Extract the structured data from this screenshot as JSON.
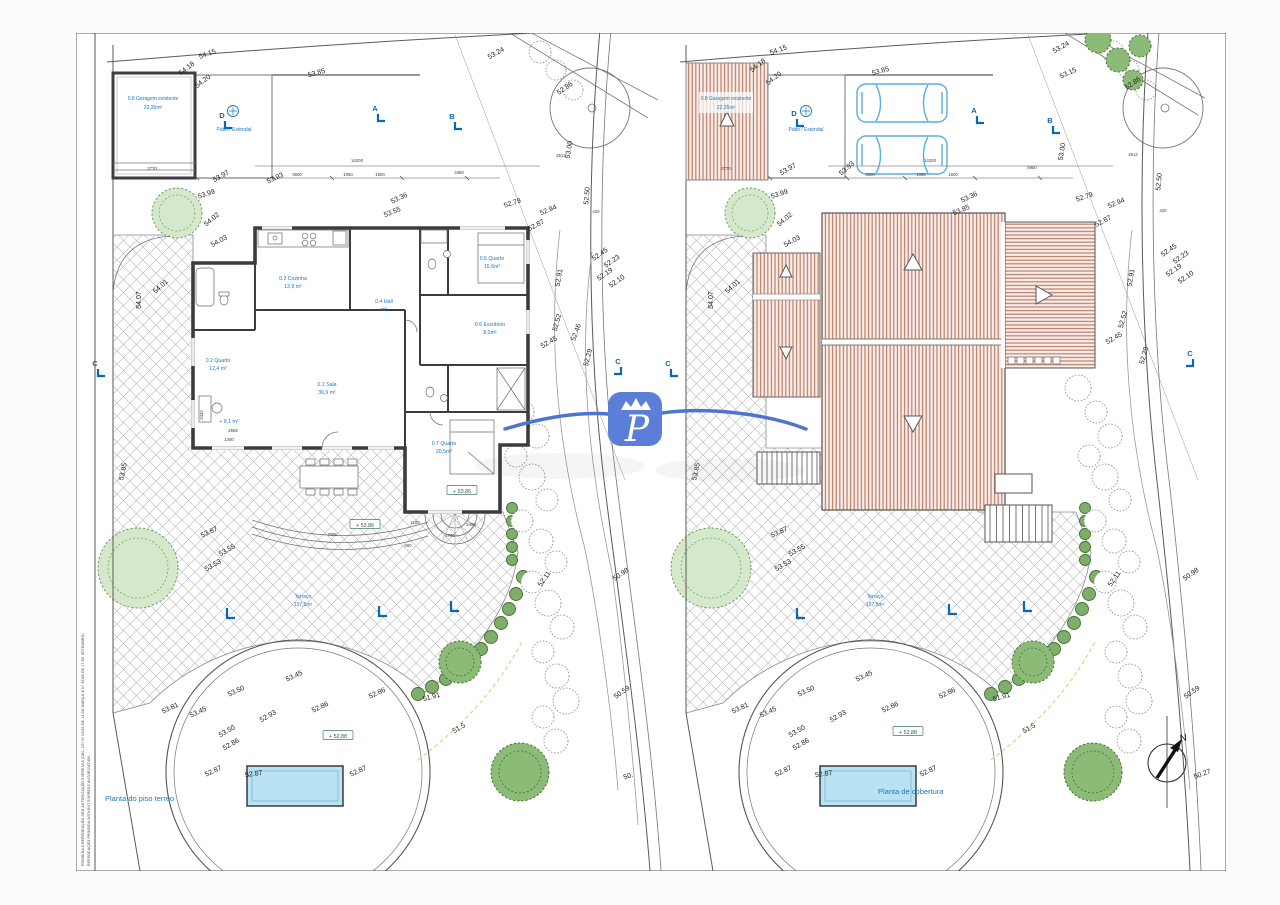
{
  "colors": {
    "blue_label": "#1878be",
    "marker_blue": "#0c67b0",
    "roof_stripe": "#c28472",
    "pool_fill": "#b9e2f2",
    "logo_blue": "#5b7ed8",
    "swoosh_blue": "#4f74d0"
  },
  "watermark": {
    "logo_letter": "P"
  },
  "copyright": {
    "line1": "PROIBIDA A REPRODUÇÃO SEM AUTORIZAÇÃO EXPRESSA (DEC. LEI Nº 63/85 DE 14 DE MARÇO E Nº 45/85 DE 17 DE SETEMBRO)",
    "line2": "REPRODUÇÃO PROIBIDA WITHOUT EXPRESS AUTORIZATION"
  },
  "left_plan": {
    "title": "Planta do piso terreo",
    "markers": [
      {
        "t": "D",
        "x": 222,
        "y": 118
      },
      {
        "t": "A",
        "x": 375,
        "y": 111
      },
      {
        "t": "B",
        "x": 452,
        "y": 119
      },
      {
        "t": "C",
        "x": 95,
        "y": 366
      },
      {
        "t": "C",
        "x": 618,
        "y": 364,
        "m": -1
      }
    ],
    "boxes": [
      {
        "t": "+ 53.86",
        "x": 365,
        "y": 526
      },
      {
        "t": "+ 53.86",
        "x": 462,
        "y": 492
      },
      {
        "t": "+ 52.88",
        "x": 338,
        "y": 737
      }
    ],
    "texts": [
      {
        "t": "0.8 Garagem existente",
        "x": 153,
        "y": 100,
        "c": "b6"
      },
      {
        "t": "22,26m²",
        "x": 153,
        "y": 109,
        "c": "b6"
      },
      {
        "t": "Pátio / Estendal",
        "x": 234,
        "y": 131,
        "c": "b6"
      },
      {
        "t": "0.1 Sala",
        "x": 327,
        "y": 386,
        "c": "r"
      },
      {
        "t": "36,9 m²",
        "x": 327,
        "y": 394,
        "c": "r"
      },
      {
        "t": "0.2 Quarto",
        "x": 218,
        "y": 362,
        "c": "r"
      },
      {
        "t": "12,4 m²",
        "x": 218,
        "y": 370,
        "c": "r"
      },
      {
        "t": "0.3 Cozinha",
        "x": 293,
        "y": 280,
        "c": "r"
      },
      {
        "t": "12,9 m²",
        "x": 293,
        "y": 288,
        "c": "r"
      },
      {
        "t": "0.4 Hall",
        "x": 384,
        "y": 303,
        "c": "r"
      },
      {
        "t": "m²",
        "x": 384,
        "y": 311,
        "c": "r"
      },
      {
        "t": "0.5 Quarto",
        "x": 492,
        "y": 260,
        "c": "r"
      },
      {
        "t": "15,6m²",
        "x": 492,
        "y": 268,
        "c": "r"
      },
      {
        "t": "0.6 Escritório",
        "x": 490,
        "y": 326,
        "c": "r"
      },
      {
        "t": "8,0m²",
        "x": 490,
        "y": 334,
        "c": "r"
      },
      {
        "t": "0.7 Quarto",
        "x": 444,
        "y": 445,
        "c": "r"
      },
      {
        "t": "20,5m²",
        "x": 444,
        "y": 453,
        "c": "r"
      },
      {
        "t": "+ 8,1 m²",
        "x": 229,
        "y": 423,
        "c": "r"
      },
      {
        "t": "Terraço",
        "x": 303,
        "y": 598,
        "c": "b6"
      },
      {
        "t": "137,5m²",
        "x": 303,
        "y": 606,
        "c": "b6"
      },
      {
        "t": "54.15",
        "x": 208,
        "y": 56,
        "r": -20,
        "c": "e"
      },
      {
        "t": "54.18",
        "x": 188,
        "y": 70,
        "r": -38,
        "c": "e"
      },
      {
        "t": "54.20",
        "x": 204,
        "y": 83,
        "r": -38,
        "c": "e"
      },
      {
        "t": "53.85",
        "x": 317,
        "y": 75,
        "r": -15,
        "c": "e"
      },
      {
        "t": "53.24",
        "x": 497,
        "y": 55,
        "r": -30,
        "c": "e"
      },
      {
        "t": "52.86",
        "x": 566,
        "y": 90,
        "r": -35,
        "c": "e"
      },
      {
        "t": "53.97",
        "x": 222,
        "y": 178,
        "r": -30,
        "c": "e"
      },
      {
        "t": "53.93",
        "x": 276,
        "y": 180,
        "r": -25,
        "c": "e"
      },
      {
        "t": "53.99",
        "x": 207,
        "y": 196,
        "r": -18,
        "c": "e"
      },
      {
        "t": "54.02",
        "x": 213,
        "y": 221,
        "r": -40,
        "c": "e"
      },
      {
        "t": "54.03",
        "x": 220,
        "y": 243,
        "r": -28,
        "c": "e"
      },
      {
        "t": "54.01",
        "x": 162,
        "y": 288,
        "r": -42,
        "c": "e"
      },
      {
        "t": "54.07",
        "x": 141,
        "y": 300,
        "r": -90,
        "c": "e"
      },
      {
        "t": "53.85",
        "x": 125,
        "y": 472,
        "r": -78,
        "c": "e"
      },
      {
        "t": "53.36",
        "x": 400,
        "y": 200,
        "r": -25,
        "c": "e"
      },
      {
        "t": "53.55",
        "x": 393,
        "y": 214,
        "r": -22,
        "c": "e"
      },
      {
        "t": "53.00",
        "x": 571,
        "y": 150,
        "r": -80,
        "c": "e"
      },
      {
        "t": "52.50",
        "x": 589,
        "y": 196,
        "r": -85,
        "c": "e"
      },
      {
        "t": "52.79",
        "x": 513,
        "y": 205,
        "r": -18,
        "c": "e"
      },
      {
        "t": "52.94",
        "x": 549,
        "y": 212,
        "r": -22,
        "c": "e"
      },
      {
        "t": "52.87",
        "x": 537,
        "y": 227,
        "r": -28,
        "c": "e"
      },
      {
        "t": "52.45",
        "x": 601,
        "y": 256,
        "r": -35,
        "c": "e"
      },
      {
        "t": "52.23",
        "x": 613,
        "y": 263,
        "r": -35,
        "c": "e"
      },
      {
        "t": "52.19",
        "x": 606,
        "y": 276,
        "r": -35,
        "c": "e"
      },
      {
        "t": "52.10",
        "x": 618,
        "y": 283,
        "r": -35,
        "c": "e"
      },
      {
        "t": "52.91",
        "x": 561,
        "y": 278,
        "r": -80,
        "c": "e"
      },
      {
        "t": "52.52",
        "x": 559,
        "y": 323,
        "r": -75,
        "c": "e"
      },
      {
        "t": "52.46",
        "x": 578,
        "y": 333,
        "r": -70,
        "c": "e"
      },
      {
        "t": "52.45",
        "x": 550,
        "y": 344,
        "r": -30,
        "c": "e"
      },
      {
        "t": "52.29",
        "x": 590,
        "y": 358,
        "r": -75,
        "c": "e"
      },
      {
        "t": "53.87",
        "x": 210,
        "y": 534,
        "r": -25,
        "c": "e"
      },
      {
        "t": "53.55",
        "x": 228,
        "y": 552,
        "r": -30,
        "c": "e"
      },
      {
        "t": "53.53",
        "x": 214,
        "y": 567,
        "r": -30,
        "c": "e"
      },
      {
        "t": "52.11",
        "x": 546,
        "y": 580,
        "r": -55,
        "c": "e"
      },
      {
        "t": "50.98",
        "x": 622,
        "y": 576,
        "r": -35,
        "c": "e"
      },
      {
        "t": "53.45",
        "x": 295,
        "y": 678,
        "r": -25,
        "c": "e"
      },
      {
        "t": "53.50",
        "x": 237,
        "y": 693,
        "r": -25,
        "c": "e"
      },
      {
        "t": "53.81",
        "x": 171,
        "y": 710,
        "r": -25,
        "c": "e"
      },
      {
        "t": "53.45",
        "x": 199,
        "y": 714,
        "r": -25,
        "c": "e"
      },
      {
        "t": "53.50",
        "x": 228,
        "y": 733,
        "r": -30,
        "c": "e"
      },
      {
        "t": "52.86",
        "x": 232,
        "y": 746,
        "r": -30,
        "c": "e"
      },
      {
        "t": "52.93",
        "x": 269,
        "y": 718,
        "r": -30,
        "c": "e"
      },
      {
        "t": "52.86",
        "x": 321,
        "y": 709,
        "r": -25,
        "c": "e"
      },
      {
        "t": "52.86",
        "x": 378,
        "y": 695,
        "r": -25,
        "c": "e"
      },
      {
        "t": "51.91",
        "x": 432,
        "y": 699,
        "r": -15,
        "c": "e"
      },
      {
        "t": "51.5",
        "x": 460,
        "y": 730,
        "r": -30,
        "c": "e"
      },
      {
        "t": "50.59",
        "x": 623,
        "y": 694,
        "r": -35,
        "c": "e"
      },
      {
        "t": "52.87",
        "x": 214,
        "y": 773,
        "r": -25,
        "c": "e"
      },
      {
        "t": "52.87",
        "x": 254,
        "y": 776,
        "r": -8,
        "c": "e"
      },
      {
        "t": "52.87",
        "x": 359,
        "y": 773,
        "r": -25,
        "c": "e"
      },
      {
        "t": "50.",
        "x": 629,
        "y": 778,
        "r": -20,
        "c": "e"
      },
      {
        "t": "14200",
        "x": 357,
        "y": 162,
        "c": "d"
      },
      {
        "t": "3600",
        "x": 297,
        "y": 176,
        "c": "d"
      },
      {
        "t": "1050",
        "x": 348,
        "y": 176,
        "c": "d"
      },
      {
        "t": "1500",
        "x": 380,
        "y": 176,
        "c": "d"
      },
      {
        "t": "3450",
        "x": 459,
        "y": 174,
        "c": "d"
      },
      {
        "t": "2612",
        "x": 561,
        "y": 157,
        "c": "d"
      },
      {
        "t": "420",
        "x": 596,
        "y": 213,
        "c": "d"
      },
      {
        "t": "2770",
        "x": 152,
        "y": 170,
        "c": "d"
      },
      {
        "t": "7005",
        "x": 332,
        "y": 536,
        "c": "d"
      },
      {
        "t": "1100",
        "x": 415,
        "y": 524,
        "c": "d"
      },
      {
        "t": "2400",
        "x": 471,
        "y": 526,
        "c": "d"
      },
      {
        "t": "4700",
        "x": 450,
        "y": 537,
        "c": "d"
      },
      {
        "t": "400",
        "x": 408,
        "y": 547,
        "c": "d"
      },
      {
        "t": "2659",
        "x": 233,
        "y": 432,
        "c": "d"
      },
      {
        "t": "1400",
        "x": 229,
        "y": 441,
        "c": "d"
      },
      {
        "t": "2432",
        "x": 203,
        "y": 415,
        "r": -90,
        "c": "d"
      }
    ]
  },
  "right_plan": {
    "title": "Planta de cobertura",
    "markers": [
      {
        "t": "D",
        "x": 794,
        "y": 116
      },
      {
        "t": "A",
        "x": 974,
        "y": 113
      },
      {
        "t": "B",
        "x": 1050,
        "y": 123
      },
      {
        "t": "C",
        "x": 668,
        "y": 366
      },
      {
        "t": "C",
        "x": 1190,
        "y": 356,
        "m": -1
      }
    ],
    "boxes": [
      {
        "t": "+ 52.88",
        "x": 908,
        "y": 733
      }
    ],
    "texts": [
      {
        "t": "0.8 Garagem existente",
        "x": 726,
        "y": 100,
        "c": "b6"
      },
      {
        "t": "22,26m²",
        "x": 726,
        "y": 109,
        "c": "b6"
      },
      {
        "t": "Pátio / Estendal",
        "x": 806,
        "y": 131,
        "c": "b6"
      },
      {
        "t": "Terraço",
        "x": 875,
        "y": 598,
        "c": "b6"
      },
      {
        "t": "137,5m²",
        "x": 875,
        "y": 606,
        "c": "b6"
      },
      {
        "t": "N",
        "x": 1184,
        "y": 741,
        "r": -15,
        "c": "n"
      },
      {
        "t": "54.15",
        "x": 779,
        "y": 52,
        "r": -20,
        "c": "e"
      },
      {
        "t": "54.18",
        "x": 759,
        "y": 67,
        "r": -38,
        "c": "e"
      },
      {
        "t": "54.20",
        "x": 775,
        "y": 80,
        "r": -38,
        "c": "e"
      },
      {
        "t": "53.85",
        "x": 881,
        "y": 73,
        "r": -15,
        "c": "e"
      },
      {
        "t": "53.24",
        "x": 1062,
        "y": 49,
        "r": -30,
        "c": "e"
      },
      {
        "t": "53.15",
        "x": 1069,
        "y": 75,
        "r": -25,
        "c": "e"
      },
      {
        "t": "52.86",
        "x": 1134,
        "y": 85,
        "r": -35,
        "c": "e"
      },
      {
        "t": "53.97",
        "x": 789,
        "y": 171,
        "r": -30,
        "c": "e"
      },
      {
        "t": "53.93",
        "x": 848,
        "y": 170,
        "r": -40,
        "c": "e"
      },
      {
        "t": "53.99",
        "x": 780,
        "y": 196,
        "r": -18,
        "c": "e"
      },
      {
        "t": "54.02",
        "x": 786,
        "y": 221,
        "r": -40,
        "c": "e"
      },
      {
        "t": "54.03",
        "x": 793,
        "y": 243,
        "r": -28,
        "c": "e"
      },
      {
        "t": "54.01",
        "x": 734,
        "y": 288,
        "r": -42,
        "c": "e"
      },
      {
        "t": "54.07",
        "x": 713,
        "y": 300,
        "r": -90,
        "c": "e"
      },
      {
        "t": "53.85",
        "x": 698,
        "y": 472,
        "r": -78,
        "c": "e"
      },
      {
        "t": "53.36",
        "x": 970,
        "y": 199,
        "r": -25,
        "c": "e"
      },
      {
        "t": "53.85",
        "x": 962,
        "y": 212,
        "r": -22,
        "c": "e"
      },
      {
        "t": "53.00",
        "x": 1064,
        "y": 152,
        "r": -80,
        "c": "e"
      },
      {
        "t": "52.50",
        "x": 1161,
        "y": 182,
        "r": -85,
        "c": "e"
      },
      {
        "t": "52.79",
        "x": 1085,
        "y": 199,
        "r": -18,
        "c": "e"
      },
      {
        "t": "52.94",
        "x": 1117,
        "y": 205,
        "r": -22,
        "c": "e"
      },
      {
        "t": "52.87",
        "x": 1104,
        "y": 223,
        "r": -28,
        "c": "e"
      },
      {
        "t": "52.45",
        "x": 1170,
        "y": 252,
        "r": -35,
        "c": "e"
      },
      {
        "t": "52.23",
        "x": 1182,
        "y": 259,
        "r": -35,
        "c": "e"
      },
      {
        "t": "52.19",
        "x": 1175,
        "y": 272,
        "r": -35,
        "c": "e"
      },
      {
        "t": "52.10",
        "x": 1187,
        "y": 279,
        "r": -35,
        "c": "e"
      },
      {
        "t": "52.91",
        "x": 1133,
        "y": 278,
        "r": -80,
        "c": "e"
      },
      {
        "t": "52.52",
        "x": 1125,
        "y": 320,
        "r": -75,
        "c": "e"
      },
      {
        "t": "52.45",
        "x": 1115,
        "y": 340,
        "r": -30,
        "c": "e"
      },
      {
        "t": "52.29",
        "x": 1146,
        "y": 356,
        "r": -75,
        "c": "e"
      },
      {
        "t": "53.87",
        "x": 780,
        "y": 534,
        "r": -25,
        "c": "e"
      },
      {
        "t": "53.55",
        "x": 798,
        "y": 552,
        "r": -30,
        "c": "e"
      },
      {
        "t": "53.53",
        "x": 784,
        "y": 567,
        "r": -30,
        "c": "e"
      },
      {
        "t": "52.11",
        "x": 1116,
        "y": 580,
        "r": -55,
        "c": "e"
      },
      {
        "t": "50.98",
        "x": 1192,
        "y": 576,
        "r": -35,
        "c": "e"
      },
      {
        "t": "53.45",
        "x": 865,
        "y": 678,
        "r": -25,
        "c": "e"
      },
      {
        "t": "53.50",
        "x": 807,
        "y": 693,
        "r": -25,
        "c": "e"
      },
      {
        "t": "53.81",
        "x": 741,
        "y": 710,
        "r": -25,
        "c": "e"
      },
      {
        "t": "53.45",
        "x": 769,
        "y": 714,
        "r": -25,
        "c": "e"
      },
      {
        "t": "53.50",
        "x": 798,
        "y": 733,
        "r": -30,
        "c": "e"
      },
      {
        "t": "52.86",
        "x": 802,
        "y": 746,
        "r": -30,
        "c": "e"
      },
      {
        "t": "52.93",
        "x": 839,
        "y": 718,
        "r": -30,
        "c": "e"
      },
      {
        "t": "52.86",
        "x": 891,
        "y": 709,
        "r": -25,
        "c": "e"
      },
      {
        "t": "52.86",
        "x": 948,
        "y": 695,
        "r": -25,
        "c": "e"
      },
      {
        "t": "51.91",
        "x": 1002,
        "y": 699,
        "r": -15,
        "c": "e"
      },
      {
        "t": "51.5",
        "x": 1030,
        "y": 730,
        "r": -30,
        "c": "e"
      },
      {
        "t": "50.59",
        "x": 1193,
        "y": 694,
        "r": -35,
        "c": "e"
      },
      {
        "t": "52.87",
        "x": 784,
        "y": 773,
        "r": -25,
        "c": "e"
      },
      {
        "t": "52.87",
        "x": 824,
        "y": 776,
        "r": -8,
        "c": "e"
      },
      {
        "t": "52.87",
        "x": 929,
        "y": 773,
        "r": -25,
        "c": "e"
      },
      {
        "t": "50.27",
        "x": 1203,
        "y": 776,
        "r": -20,
        "c": "e"
      },
      {
        "t": "14200",
        "x": 930,
        "y": 162,
        "c": "d"
      },
      {
        "t": "3600",
        "x": 870,
        "y": 176,
        "c": "d"
      },
      {
        "t": "1050",
        "x": 921,
        "y": 176,
        "c": "d"
      },
      {
        "t": "1500",
        "x": 953,
        "y": 176,
        "c": "d"
      },
      {
        "t": "5950",
        "x": 1032,
        "y": 169,
        "c": "d"
      },
      {
        "t": "2612",
        "x": 1133,
        "y": 156,
        "c": "d"
      },
      {
        "t": "420",
        "x": 1163,
        "y": 212,
        "c": "d"
      },
      {
        "t": "2770",
        "x": 726,
        "y": 170,
        "c": "d"
      }
    ]
  }
}
